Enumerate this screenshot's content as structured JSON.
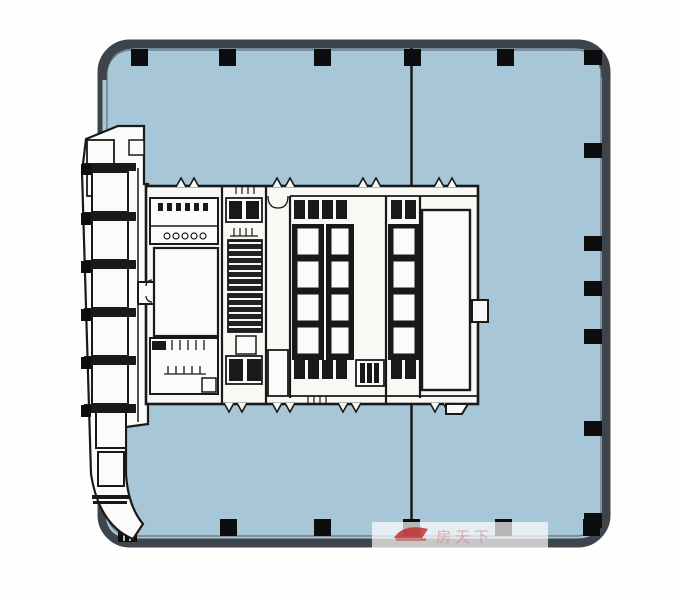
{
  "meta": {
    "title": "Office tower typical floor plan",
    "canvas": {
      "w": 680,
      "h": 600
    }
  },
  "palette": {
    "floor_blue": "#a7c6d7",
    "border_gray": "#3e444c",
    "wall_black": "#191919",
    "core_fill": "#f8f8f5",
    "room_fill": "#fbfbf9",
    "column_black": "#0d0d0d",
    "watermark_red": "#c03030",
    "watermark_pink": "#d57878"
  },
  "plate": {
    "x": 100,
    "y": 42,
    "w": 508,
    "h": 503,
    "rx": 30
  },
  "divider": {
    "x": 411.5,
    "y1": 48,
    "y2": 519
  },
  "columns": {
    "size": 17,
    "top_xs": [
      131,
      219,
      314,
      404,
      497
    ],
    "right": {
      "x": 584,
      "w": 18,
      "h": 15,
      "ys": [
        50,
        143,
        236,
        281,
        329,
        421,
        513
      ]
    },
    "bottom": {
      "y": 519,
      "xs": [
        220,
        314,
        403,
        495,
        583
      ]
    }
  },
  "left_strip": {
    "rooms": {
      "x": 92,
      "w": 36,
      "h": 40,
      "ys": [
        172,
        220,
        268,
        316,
        364
      ]
    },
    "lower_rooms": [
      {
        "x": 96,
        "y": 412,
        "w": 30,
        "h": 36
      },
      {
        "x": 98,
        "y": 452,
        "w": 26,
        "h": 34
      }
    ]
  },
  "core": {
    "banks": [
      {
        "x": 292,
        "w": 32
      },
      {
        "x": 326,
        "w": 28
      },
      {
        "x": 388,
        "w": 32
      }
    ],
    "bank_frame": {
      "y": 224,
      "h": 136
    },
    "cell": {
      "ys": [
        228,
        261,
        294,
        327
      ],
      "h": 27,
      "inset": 5
    },
    "service_boxes": {
      "w": 11,
      "h": 19,
      "top_y": 200,
      "bottom_y": 360,
      "top_xs": [
        294,
        308,
        322,
        336,
        391,
        405
      ],
      "bottom_xs": [
        294,
        308,
        322,
        336,
        391,
        405
      ]
    },
    "door_bumps": {
      "top_xs": [
        176,
        272,
        358,
        434
      ],
      "bottom_xs": [
        224,
        272,
        338,
        430
      ]
    }
  },
  "watermark": {
    "text": "房天下"
  }
}
